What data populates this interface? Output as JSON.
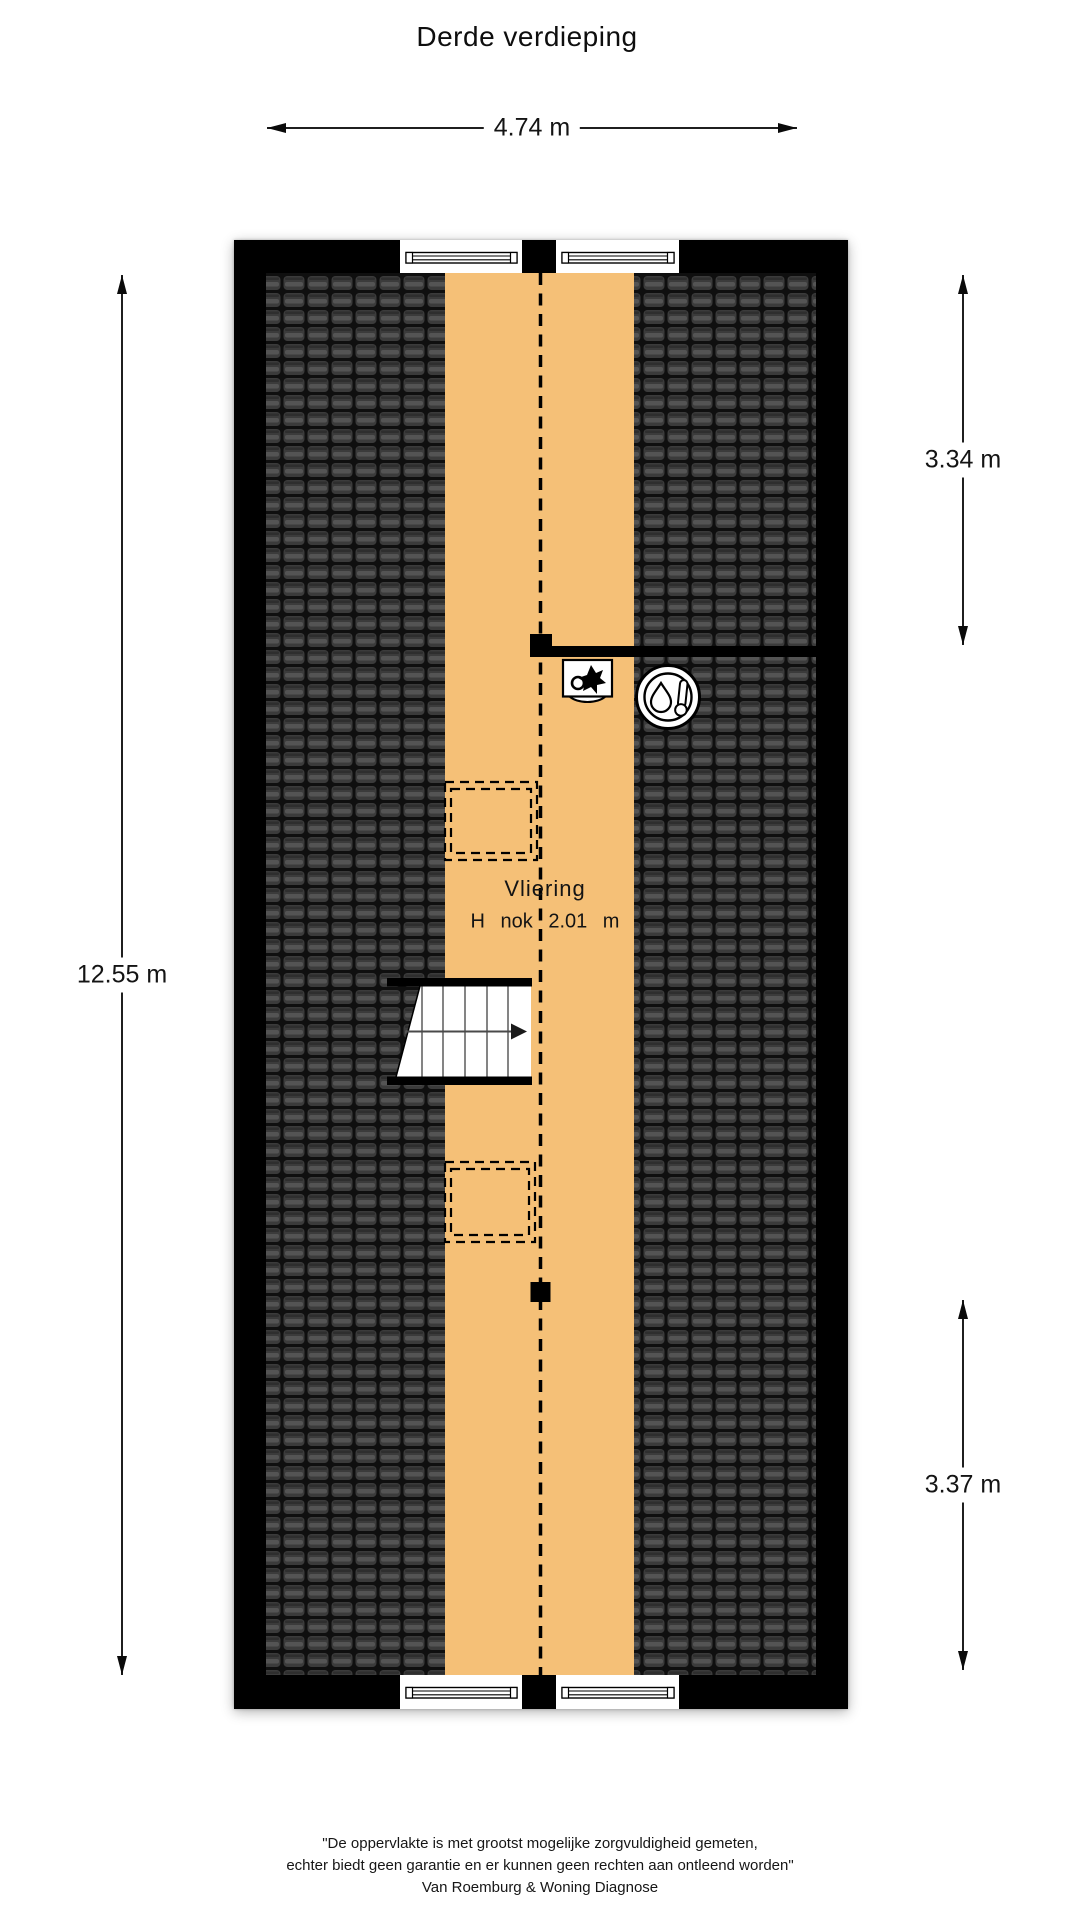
{
  "title": "Derde verdieping",
  "dimensions": {
    "width_top": "4.74 m",
    "height_left": "12.55 m",
    "roof_right_upper": "3.34 m",
    "roof_right_lower": "3.37 m"
  },
  "room": {
    "name": "Vliering",
    "ridge_height": "H nok 2.01 m"
  },
  "icons": {
    "ventilation": "mechanical-ventilation-fan-icon",
    "heating": "boiler-thermometer-icon"
  },
  "colors": {
    "attic_floor": "#f5c077",
    "roof_tiles": "#3b3b3b",
    "walls": "#000000"
  },
  "footer": {
    "line1": "\"De oppervlakte is met grootst mogelijke zorgvuldigheid gemeten,",
    "line2": "echter biedt geen garantie en er kunnen geen rechten aan ontleend worden\"",
    "line3": "Van Roemburg & Woning Diagnose"
  }
}
